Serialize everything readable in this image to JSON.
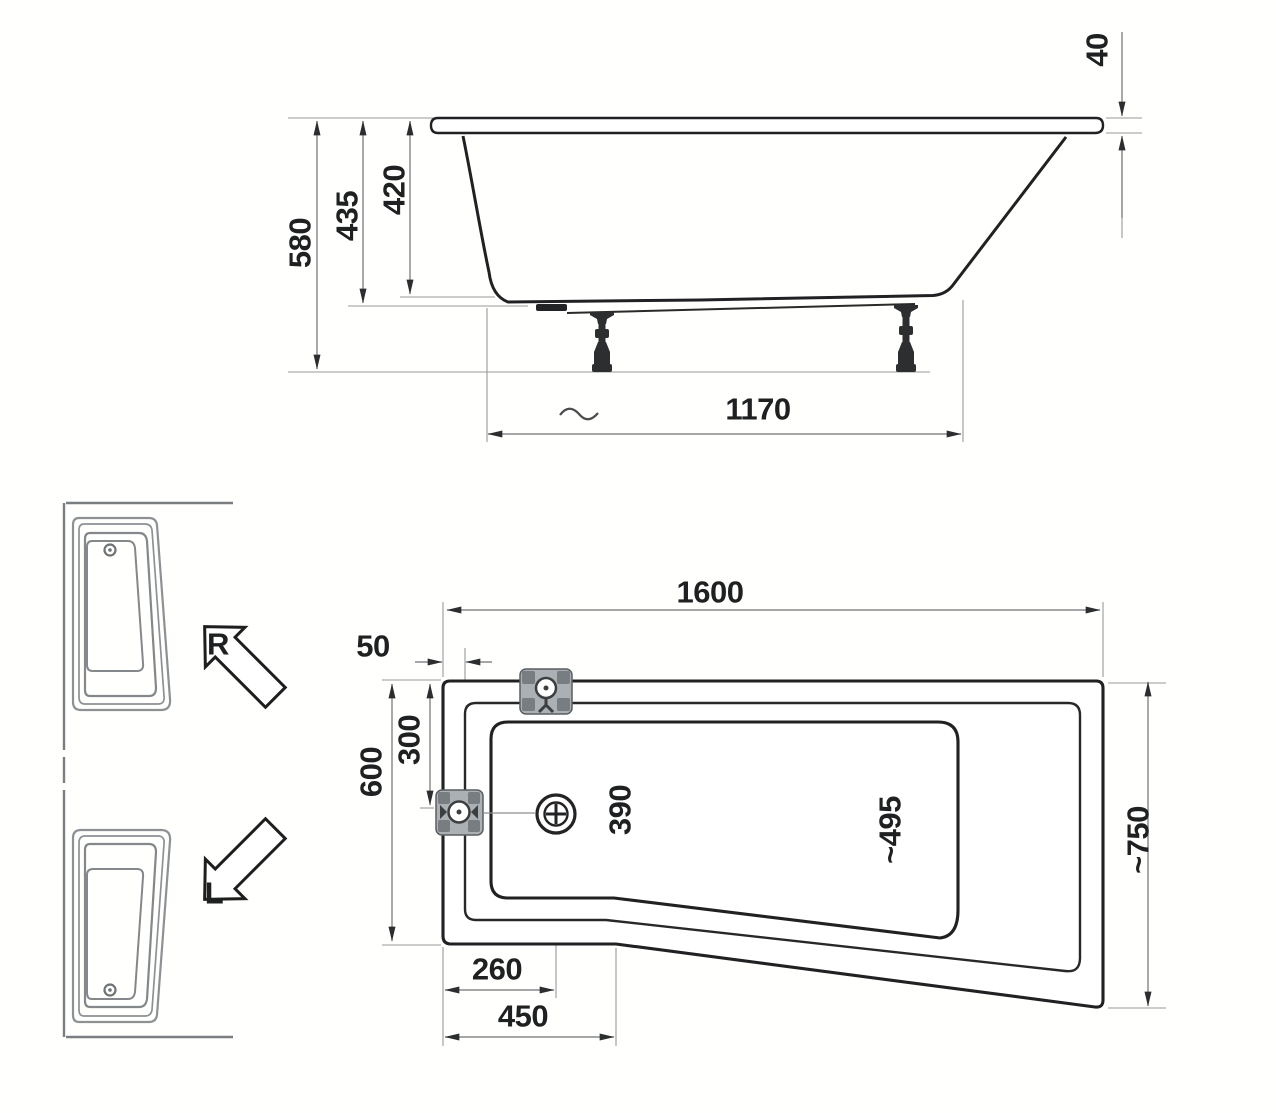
{
  "side_view": {
    "rim_thickness": "40",
    "overall_height": "580",
    "shell_height": "435",
    "inner_depth": "420",
    "base_length": "1170"
  },
  "plan_view": {
    "overall_length": "1600",
    "rim_offset": "50",
    "narrow_end_width": "600",
    "overflow_offset": "300",
    "basin_width_drain_end": "390",
    "basin_width_head_end": "~495",
    "wide_end_width": "~750",
    "drain_offset": "260",
    "taper_start": "450"
  },
  "variants": {
    "right_label": "R",
    "left_label": "L"
  }
}
